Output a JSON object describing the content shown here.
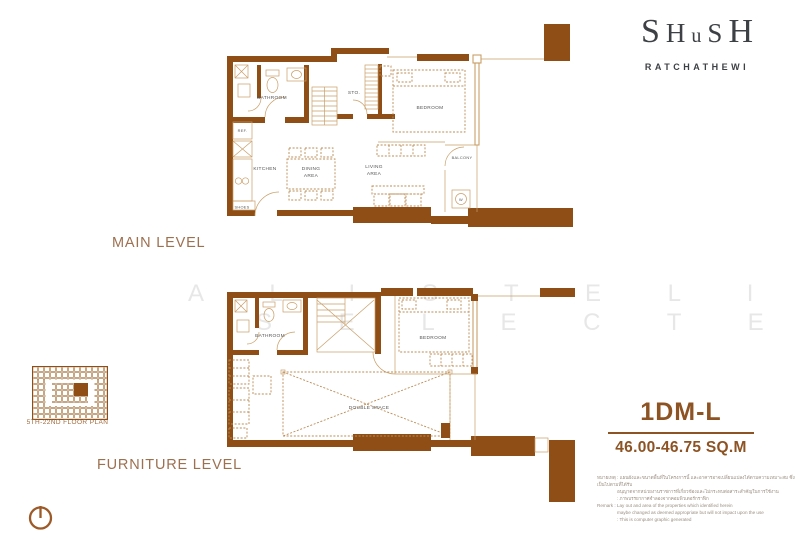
{
  "brand": {
    "letters": [
      "S",
      "H",
      "u",
      "S",
      "H"
    ],
    "location": "RATCHATHEWI"
  },
  "watermark": {
    "row1": "A L I S T E L I T E",
    "row2": "S E L E C T E D"
  },
  "plans": {
    "main": {
      "title": "MAIN LEVEL",
      "rooms": {
        "bathroom": "BATHROOM",
        "storage": "STO.",
        "bedroom": "BEDROOM",
        "balcony": "BALCONY",
        "washer": "W",
        "fridge": "REF.",
        "kitchen": "KITCHEN",
        "dining": [
          "DINING",
          "AREA"
        ],
        "living": [
          "LIVING",
          "AREA"
        ],
        "shoes": "SHOES"
      }
    },
    "furniture": {
      "title": "FURNITURE LEVEL",
      "rooms": {
        "bathroom": "BATHROOM",
        "bedroom": "BEDROOM",
        "double_space": "DOUBLE SPACE"
      }
    }
  },
  "key_plan": {
    "caption": "5TH-22ND FLOOR PLAN"
  },
  "unit": {
    "code": "1DM-L",
    "area": "46.00-46.75 SQ.M"
  },
  "disclaimer": {
    "thai_1": "หมายเหตุ : แผนผังและขนาดพื้นที่ในโครงการนี้ และอาคารอาจเปลี่ยนแปลงได้ตามความเหมาะสม ซึ่งเป็นไปตามที่ได้รับ",
    "thai_2": "อนุญาตจากหน่วยงานราชการที่เกี่ยวข้องและไม่กระทบต่อสาระสำคัญในการใช้งาน",
    "thai_3": ": ภาพบรรยากาศจำลองจากคอมพิวเตอร์กราฟิก",
    "en_1": "Remark : Lay out and area of the properties which identified herein",
    "en_2": "maybe changed as deemed appropriate but will not impact upon the use",
    "en_3": ": This is computer graphic generated"
  },
  "colors": {
    "wall": "#8e4e15",
    "thin_line": "#c99f68",
    "furniture_dash": "#bb8c55",
    "accent_text": "#8d5322",
    "level_label": "#9d7050",
    "logo_text": "#3d4044"
  }
}
